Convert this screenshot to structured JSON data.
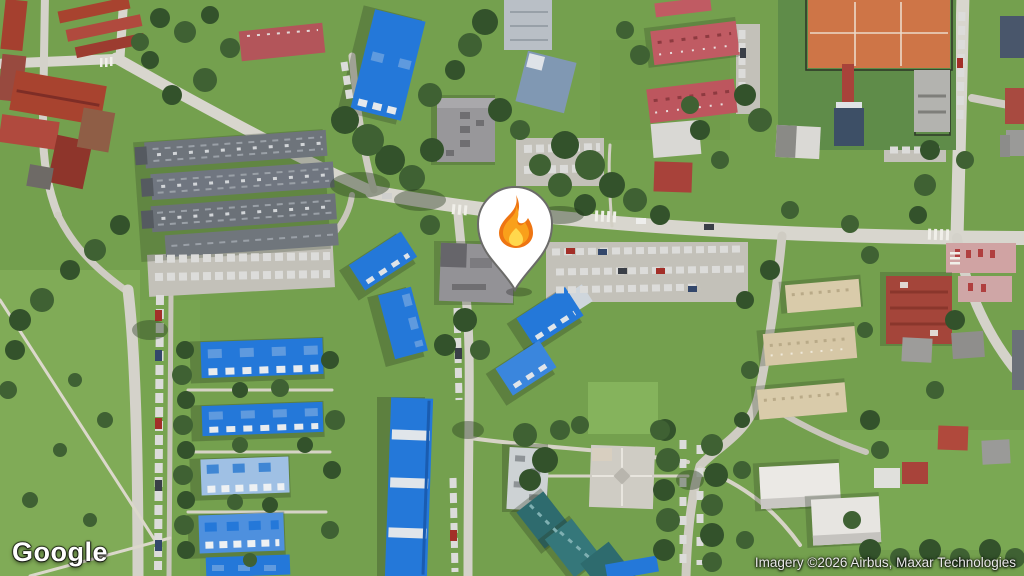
{
  "map": {
    "view_type": "satellite",
    "marker": {
      "icon": "fire-emoji",
      "emoji": "🔥"
    },
    "colors": {
      "grass": "#74a04e",
      "park_grass": "#80ab57",
      "trees": "#33522b",
      "road": "#d8d6ce",
      "blue_roof": "#2478d9",
      "light_blue_roof": "#9fc0e4",
      "red_roof": "#a03b31",
      "pink_roof": "#c05b63",
      "cream_roof": "#d9cbaa",
      "warehouse_gray": "#6e747b",
      "tennis_clay": "#ce7547",
      "teal_roof": "#2e6b6e",
      "pin_fill": "#ffffff",
      "pin_border": "#6b6b69",
      "flame_outer": "#ee7512",
      "flame_inner": "#f9a01b",
      "flame_core": "#ffd84d"
    }
  },
  "footer": {
    "logo_text": "Google",
    "attribution": "Imagery ©2026 Airbus, Maxar Technologies"
  }
}
